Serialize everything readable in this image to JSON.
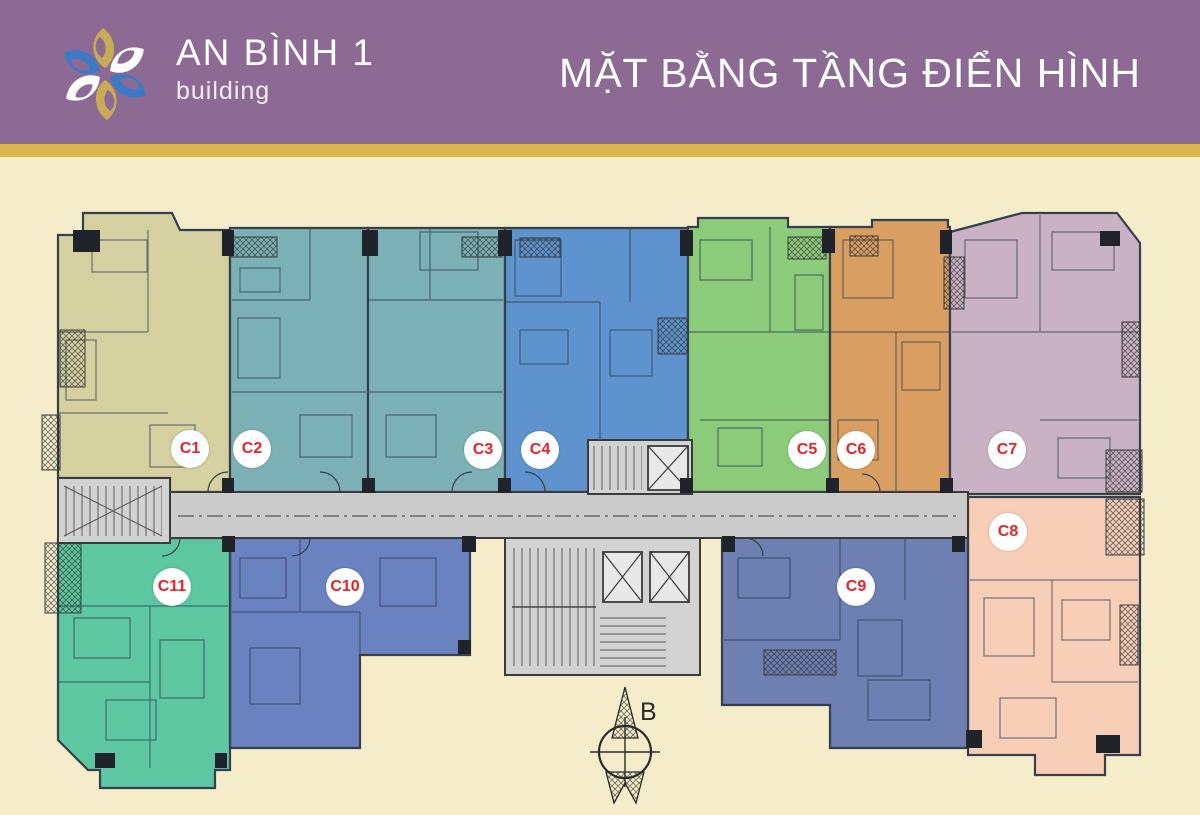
{
  "page": {
    "bg_color": "#f5edca"
  },
  "header": {
    "bg_color": "#8d6a94",
    "band_color": "#d9b54e",
    "logo": {
      "title": "AN BÌNH 1",
      "subtitle": "building",
      "leaf_gold": "#c7ab55",
      "leaf_blue": "#3e79c5",
      "leaf_white": "#ffffff"
    },
    "title": "MẶT BẰNG TẦNG ĐIỂN HÌNH"
  },
  "plan": {
    "compass_label": "B",
    "label_color": "#e2242a",
    "corridor_color": "#cbcbcb",
    "core_color": "#d2d2d2",
    "wall_color": "#3b3b3b",
    "units": [
      {
        "label": "C1",
        "color": "#d5d0a0"
      },
      {
        "label": "C2",
        "color": "#7bb0b4"
      },
      {
        "label": "C3",
        "color": "#7bb0b4"
      },
      {
        "label": "C4",
        "color": "#5e93cd"
      },
      {
        "label": "C5",
        "color": "#8bcb7a"
      },
      {
        "label": "C6",
        "color": "#d99f62"
      },
      {
        "label": "C7",
        "color": "#c8b2c4"
      },
      {
        "label": "C8",
        "color": "#f7cfb7"
      },
      {
        "label": "C9",
        "color": "#6d80b1"
      },
      {
        "label": "C10",
        "color": "#6b82c0"
      },
      {
        "label": "C11",
        "color": "#5dc7a1"
      }
    ]
  }
}
